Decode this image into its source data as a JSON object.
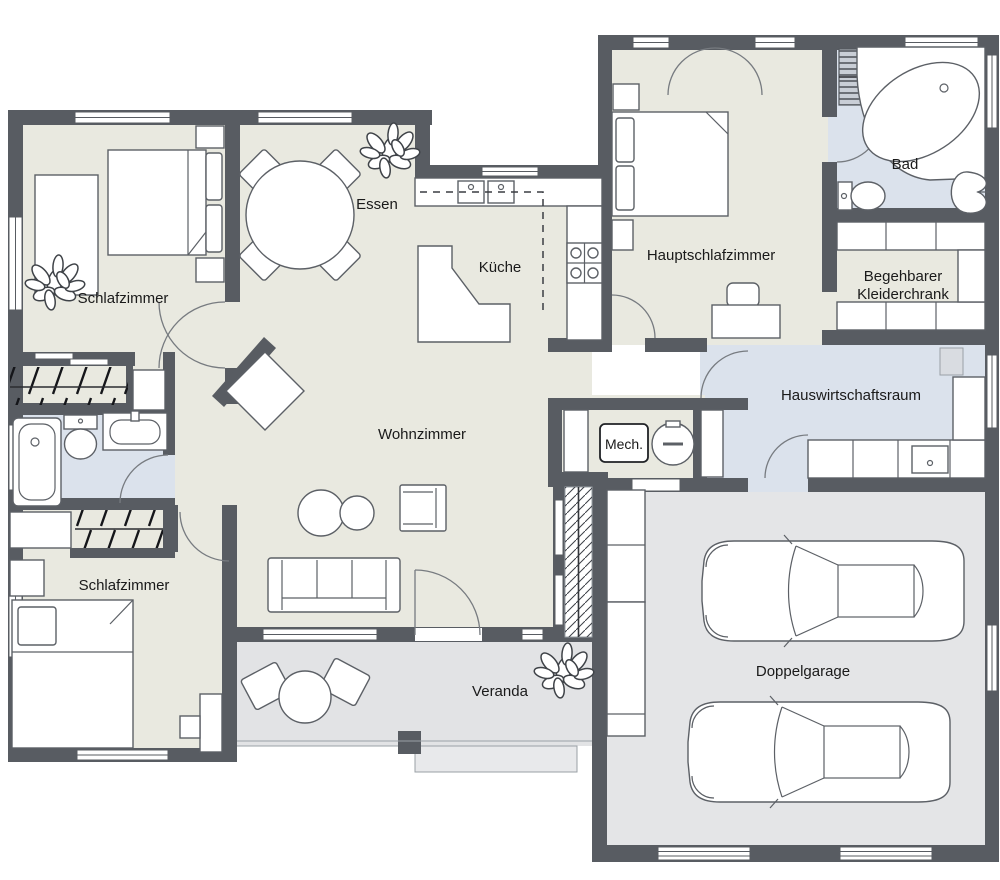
{
  "plan": {
    "type": "residential-floor-plan",
    "language": "de"
  },
  "labels": {
    "schlafzimmer_top": "Schlafzimmer",
    "essen": "Essen",
    "kueche": "Küche",
    "hauptschlafzimmer": "Hauptschlafzimmer",
    "bad": "Bad",
    "kleiderschrank_line1": "Begehbarer",
    "kleiderschrank_line2": "Kleiderchrank",
    "hauswirtschaftsraum": "Hauswirtschaftsraum",
    "wohnzimmer": "Wohnzimmer",
    "mech": "Mech.",
    "schlafzimmer_bottom": "Schlafzimmer",
    "veranda": "Veranda",
    "doppelgarage": "Doppelgarage"
  },
  "colors": {
    "wall": "#585c62",
    "room_beige": "#e9e9e0",
    "room_blue": "#dbe2ec",
    "room_gray": "#e4e5e7",
    "veranda_gray": "#e2e3e5",
    "step_gray": "#e8e9eb",
    "outline": "#5c6066",
    "label": "#1a1a1a"
  }
}
